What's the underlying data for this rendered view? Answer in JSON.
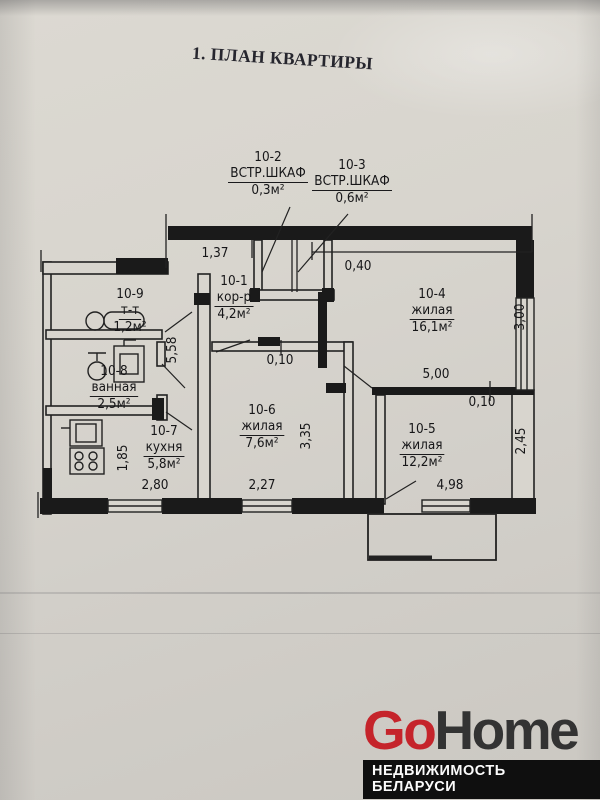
{
  "title": "1. ПЛАН КВАРТИРЫ",
  "rooms": {
    "closet2": {
      "id": "10-2",
      "name": "ВСТР.ШКАФ",
      "area": "0,3м²"
    },
    "closet3": {
      "id": "10-3",
      "name": "ВСТР.ШКАФ",
      "area": "0,6м²"
    },
    "corridor": {
      "id": "10-1",
      "name": "кор-р",
      "area": "4,2м²"
    },
    "living4": {
      "id": "10-4",
      "name": "жилая",
      "area": "16,1м²"
    },
    "toilet": {
      "id": "10-9",
      "name": "т-т",
      "area": "1,2м²"
    },
    "bathroom": {
      "id": "10-8",
      "name": "ванная",
      "area": "2,5м²"
    },
    "living6": {
      "id": "10-6",
      "name": "жилая",
      "area": "7,6м²"
    },
    "living5": {
      "id": "10-5",
      "name": "жилая",
      "area": "12,2м²"
    },
    "kitchen": {
      "id": "10-7",
      "name": "кухня",
      "area": "5,8м²"
    }
  },
  "dimensions": {
    "top_left": "1,37",
    "top_right": "0,40",
    "right_window": "3,00",
    "corridor_height": "5,58",
    "wall_thickness_top": "0,10",
    "partition_length": "5,00",
    "wall_thickness_bottom": "0,10",
    "living6_right": "3,35",
    "living5_right": "2,45",
    "kitchen_left": "1,85",
    "kitchen_width": "2,80",
    "living6_width": "2,27",
    "living5_width": "4,98"
  },
  "watermark": {
    "brand_red": "Go",
    "brand_dark": "Home",
    "tagline": "НЕДВИЖИМОСТЬ БЕЛАРУСИ",
    "accent_color": "#c5242b",
    "dark_color": "#333333"
  },
  "colors": {
    "paper": "#d8d5ce",
    "ink": "#1b1b1e"
  }
}
